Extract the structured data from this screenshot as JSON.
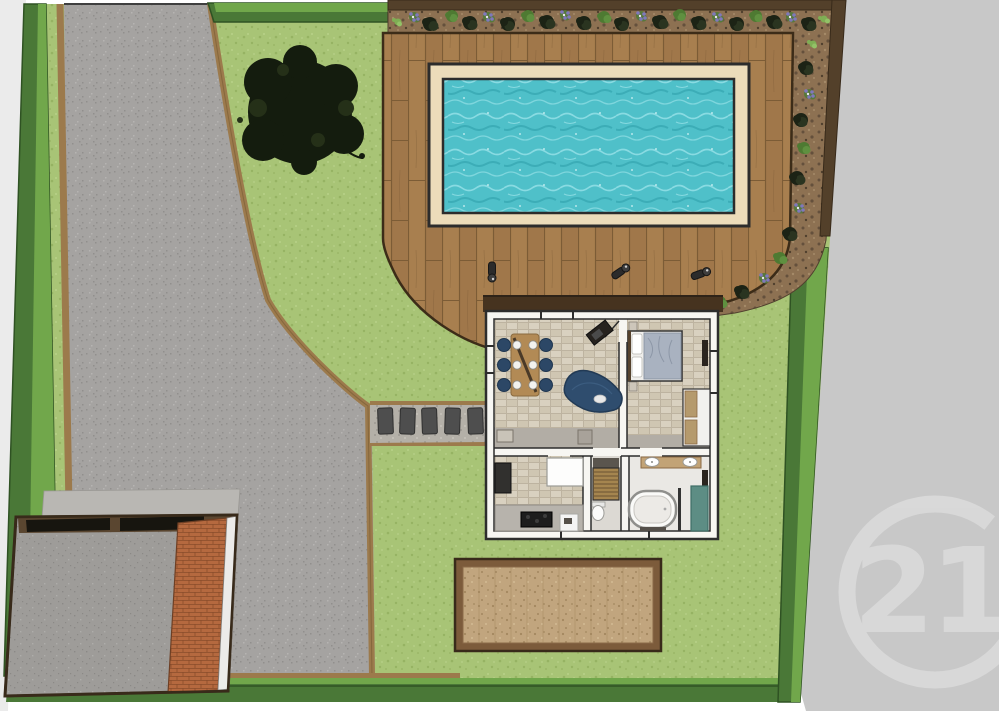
{
  "watermark": {
    "text": "21"
  },
  "palette": {
    "page_bg": "#ffffff",
    "margin_gray": "#ebebeb",
    "outside_gray": "#c8c8c8",
    "watermark_gray": "#dadada",
    "lawn": "#a8c476",
    "lawn_dark": "#96b363",
    "lawn_light": "#b8d189",
    "hedge_dark": "#4a7837",
    "hedge_light": "#71a74b",
    "hedge_line": "#2f5223",
    "curb": "#9c7a4c",
    "curb_dark": "#7c5f38",
    "driveway": "#a5a3a1",
    "driveway_dark": "#918f8d",
    "driveway_light": "#b6b4b2",
    "deck_wood": "#a87f4f",
    "deck_wood2": "#a0774a",
    "deck_seam": "#7c5c36",
    "deck_edge": "#3c2c18",
    "pool_coping": "#ecdcba",
    "pool_rim": "#2c2c2c",
    "pool_water": "#4fc0c9",
    "pool_water_light": "#93e0e6",
    "pool_water_dark": "#2fa0ab",
    "mulch": "#8d7152",
    "mulch_dark": "#64503c",
    "mulch_dark2": "#50402e",
    "mulch_light": "#a58a68",
    "fence": "#53402a",
    "fence_dark": "#382a1a",
    "tree": "#141c0e",
    "tree2": "#253018",
    "shadow_band": "#46331f",
    "house_wall": "#f7f6f2",
    "wall_line": "#2d2d2d",
    "floor_tile": "#d9d1c0",
    "floor_tile2": "#cfc6b2",
    "grout": "#bdb3a0",
    "gray_band": "#b2ada5",
    "hall_floor": "#dcd9d3",
    "bath_floor": "#eae8e4",
    "navy": "#2c4766",
    "navy_dark": "#1f3650",
    "table_wood": "#b28a55",
    "sofa": "#2f4d6e",
    "duvet": "#a9b2c0",
    "duvet_line": "#8d97a7",
    "counter_gray": "#b7b3ac",
    "appliance_dark": "#1d1d1d",
    "stair_wood": "#a5854f",
    "stair_line": "#6b5433",
    "vanity": "#c2a376",
    "shower": "#5d8d84",
    "tub_rim": "#8f8f8c",
    "roof_gray": "#9e9c99",
    "roof_dark": "#8b8986",
    "roof_light": "#afadaa",
    "concrete": "#b9b7b3",
    "brick": "#b5693f",
    "brick_line": "#8a4c2a",
    "band_dark": "#17150f",
    "band_frame": "#5a4630",
    "sliver": "#ecebe9",
    "patio_frame": "#7c5b3b",
    "patio_gravel": "#c1a57e",
    "patio_dark": "#a3875f",
    "patio_light": "#d2ba93",
    "gravel": "#b4b0a8",
    "gravel_dark": "#9d9992",
    "gravel_light": "#c6c2ba",
    "stone": "#4e4e4e"
  },
  "garden": {
    "plant_types": {
      "bush": {
        "colors": [
          "#1c2315",
          "#2a3420"
        ],
        "radii": [
          7,
          5,
          4
        ]
      },
      "shrub": {
        "colors": [
          "#4e7a32",
          "#5f9040"
        ],
        "radii": [
          6,
          4,
          3
        ]
      },
      "flower": {
        "colors": [
          "#57793a",
          "#8078bc",
          "#e8e8f0"
        ],
        "radii": [
          5,
          3.5,
          1.2
        ]
      },
      "grass": {
        "colors": [
          "#7fae54",
          "#93c267"
        ],
        "radii": [
          3.5,
          2.5,
          2
        ]
      }
    },
    "top_bed_plants": [
      [
        398,
        22,
        "grass"
      ],
      [
        414,
        17,
        "flower"
      ],
      [
        430,
        24,
        "bush"
      ],
      [
        452,
        16,
        "shrub"
      ],
      [
        470,
        23,
        "bush"
      ],
      [
        488,
        17,
        "flower"
      ],
      [
        508,
        24,
        "bush"
      ],
      [
        528,
        16,
        "shrub"
      ],
      [
        547,
        22,
        "bush"
      ],
      [
        565,
        15,
        "flower"
      ],
      [
        584,
        23,
        "bush"
      ],
      [
        604,
        17,
        "shrub"
      ],
      [
        622,
        24,
        "bush"
      ],
      [
        641,
        16,
        "flower"
      ],
      [
        660,
        22,
        "bush"
      ],
      [
        680,
        15,
        "shrub"
      ],
      [
        699,
        23,
        "bush"
      ],
      [
        717,
        17,
        "flower"
      ],
      [
        737,
        24,
        "bush"
      ],
      [
        756,
        16,
        "shrub"
      ],
      [
        774,
        22,
        "bush"
      ],
      [
        791,
        17,
        "flower"
      ],
      [
        809,
        24,
        "bush"
      ],
      [
        824,
        19,
        "grass"
      ]
    ],
    "right_bed_plants": [
      [
        813,
        44,
        "grass"
      ],
      [
        806,
        68,
        "bush"
      ],
      [
        809,
        94,
        "flower"
      ],
      [
        801,
        120,
        "bush"
      ],
      [
        804,
        148,
        "shrub"
      ],
      [
        797,
        178,
        "bush"
      ],
      [
        799,
        208,
        "flower"
      ],
      [
        790,
        234,
        "bush"
      ],
      [
        780,
        258,
        "shrub"
      ],
      [
        764,
        278,
        "flower"
      ],
      [
        742,
        292,
        "bush"
      ],
      [
        720,
        302,
        "shrub"
      ],
      [
        703,
        310,
        "grass"
      ]
    ]
  },
  "path": {
    "stones": [
      378,
      400,
      422,
      445,
      468
    ]
  },
  "deck": {
    "torches": [
      [
        492,
        271,
        90
      ],
      [
        620,
        272,
        -35
      ],
      [
        700,
        274,
        -20
      ]
    ]
  }
}
